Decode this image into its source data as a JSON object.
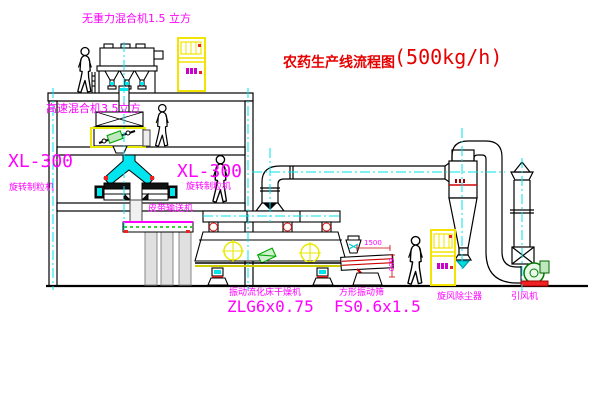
{
  "title": {
    "text": "农药生产线流程图",
    "capacity": "(500kg/h)"
  },
  "equipment_labels": {
    "gravity_free_mixer": "无重力混合机1.5 立方",
    "high_speed_mixer": "高速混合机3.5立方",
    "granulator_left_model": "XL-300",
    "granulator_left_name": "旋转制粒机",
    "granulator_right_model": "XL-300",
    "granulator_right_name": "旋转制粒机",
    "belt_conveyor": "皮带输送机",
    "fluid_bed_dryer_name": "振动流化床干燥机",
    "fluid_bed_dryer_model": "ZLG6x0.75",
    "vibrating_sieve_name": "方形振动筛",
    "vibrating_sieve_model": "FS0.6x1.5",
    "cyclone_dust_collector": "旋风除尘器",
    "induced_draft_fan": "引风机"
  },
  "dimensions": {
    "sieve_length": "1500",
    "sieve_height": "600"
  },
  "colors": {
    "background": "#ffffff",
    "line_black": "#000000",
    "label_magenta": "#ff00ff",
    "title_red": "#e60000",
    "centerline_cyan": "#00e5ee",
    "cabinet_yellow": "#f2e400",
    "highlight_yellow": "#e8e800",
    "accent_red": "#dd2222",
    "accent_green": "#00aa00"
  }
}
